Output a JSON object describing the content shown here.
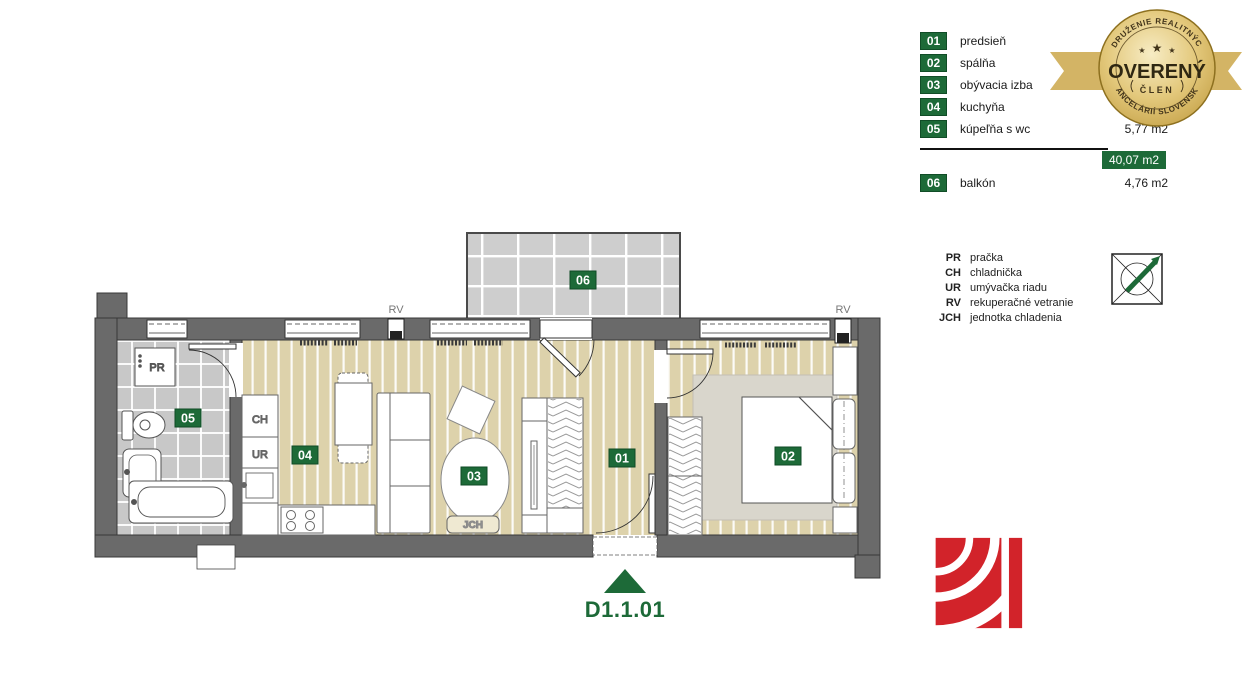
{
  "legend": {
    "rooms": [
      {
        "num": "01",
        "label": "predsieň",
        "area": ""
      },
      {
        "num": "02",
        "label": "spálňa",
        "area": ""
      },
      {
        "num": "03",
        "label": "obývacia izba",
        "area": ""
      },
      {
        "num": "04",
        "label": "kuchyňa",
        "area": ""
      },
      {
        "num": "05",
        "label": "kúpeľňa s wc",
        "area": "5,77 m2"
      },
      {
        "num": "06",
        "label": "balkón",
        "area": "4,76 m2"
      }
    ],
    "total_area": "40,07 m2"
  },
  "certificate_badge": {
    "arc_top": "ZDRUŽENIE REALITNÝCH",
    "title": "OVERENÝ",
    "subtitle": "ČLEN",
    "arc_bottom": "KANCELÁRIÍ SLOVENSKA",
    "star": "★"
  },
  "abbreviations": [
    {
      "abbr": "PR",
      "label": "pračka"
    },
    {
      "abbr": "CH",
      "label": "chladnička"
    },
    {
      "abbr": "UR",
      "label": "umývačka riadu"
    },
    {
      "abbr": "RV",
      "label": "rekuperačné vetranie"
    },
    {
      "abbr": "JCH",
      "label": "jednotka chladenia"
    }
  ],
  "plan": {
    "unit_id": "D1.1.01",
    "rv": "RV",
    "jch": "JCH",
    "pr": "PR",
    "ch": "CH",
    "ur": "UR"
  },
  "colors": {
    "green": "#1d6a38",
    "gold": "#d8bc72",
    "red": "#d2232a",
    "wall": "#6a6a6a",
    "floor": "#ddd2ab",
    "tile": "#c8c8c8"
  }
}
